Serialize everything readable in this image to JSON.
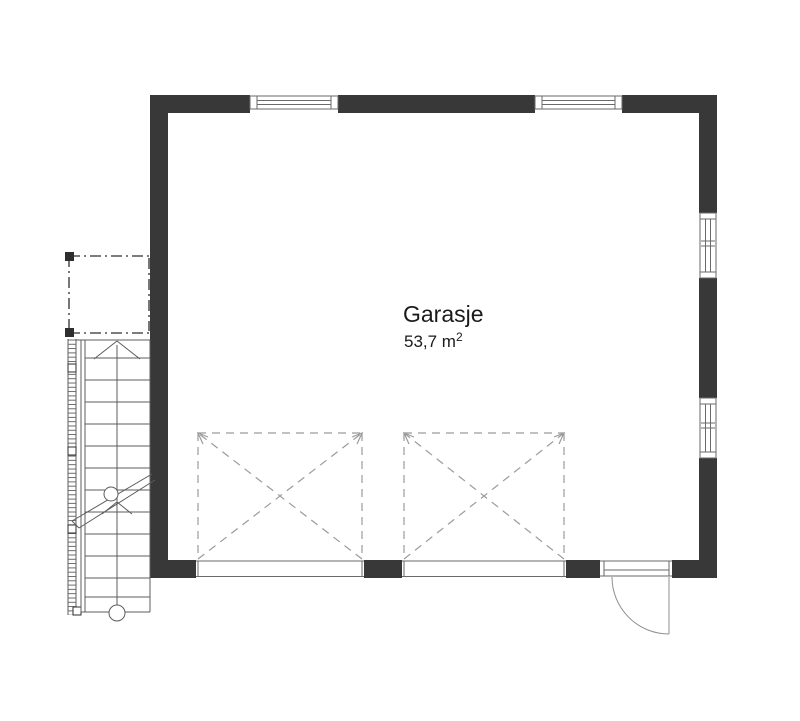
{
  "plan": {
    "room": {
      "name": "Garasje",
      "area_value": "53,7 m",
      "area_superscript": "2"
    },
    "colors": {
      "wall": "#383838",
      "thin_line": "#6a6a6a",
      "light_line": "#8f8f8f",
      "dashed_line": "#9b9b9b",
      "stair_line": "#5c5c5c",
      "dashdot_line": "#2e2e2e",
      "window_fill": "#ffffff",
      "text": "#1a1a1a",
      "background": "#ffffff"
    },
    "elements": {
      "windows": [
        "window-top-left",
        "window-top-right",
        "window-right-upper",
        "window-right-lower"
      ],
      "door": "entry-door",
      "garage_openings": [
        "garage-door-left",
        "garage-door-right"
      ],
      "stair": "external-staircase",
      "outline": "carport-outline"
    }
  }
}
